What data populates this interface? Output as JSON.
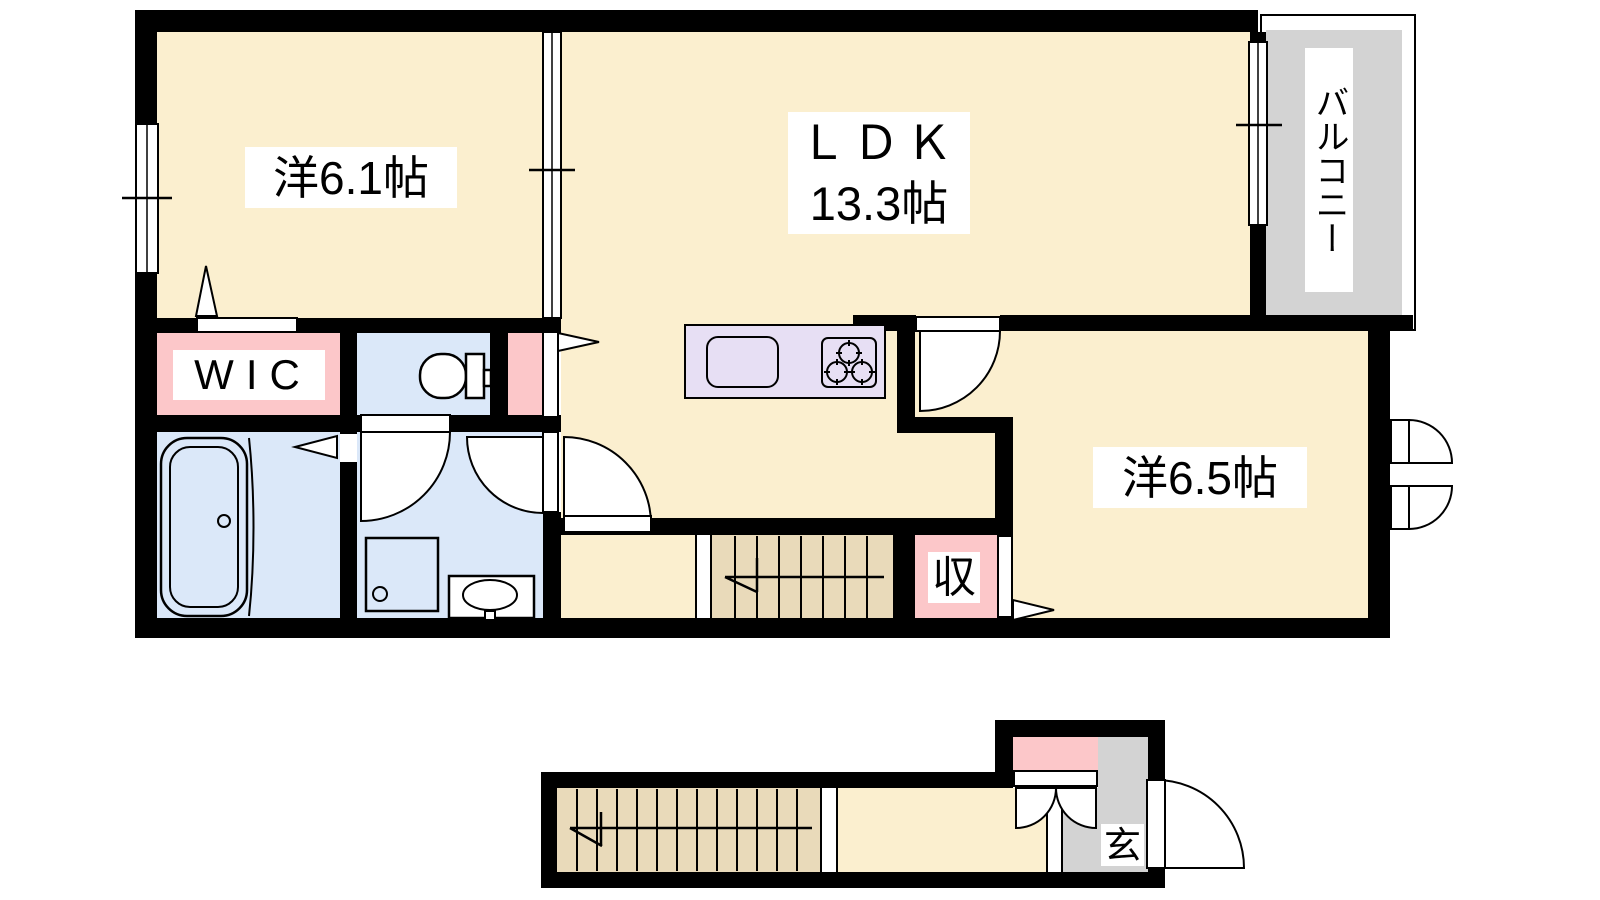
{
  "plan": {
    "type": "apartment-floor-plan",
    "labels": {
      "bedroom1": "洋6.1帖",
      "ldk_name": "ＬＤＫ",
      "ldk_size": "13.3帖",
      "bedroom2": "洋6.5帖",
      "wic": "WIC",
      "closet": "収",
      "balcony": "バルコニー",
      "entrance": "玄"
    },
    "colors": {
      "wall": "#000000",
      "room_cream": "#FBEFCF",
      "wet_area_blue": "#DBE8F9",
      "closet_pink": "#FCC7C9",
      "stairs_tan": "#E9DABA",
      "balcony_gray": "#D3D3D3",
      "kitchen_lavender": "#E7DFF4",
      "label_background": "#FFFFFF"
    },
    "icons": [
      "bathtub-icon",
      "toilet-icon",
      "washbasin-icon",
      "shower-pan-icon",
      "kitchen-sink-icon",
      "stove-icon",
      "door-swing-icon",
      "window-icon",
      "stairs-icon",
      "direction-triangle-icon"
    ]
  }
}
